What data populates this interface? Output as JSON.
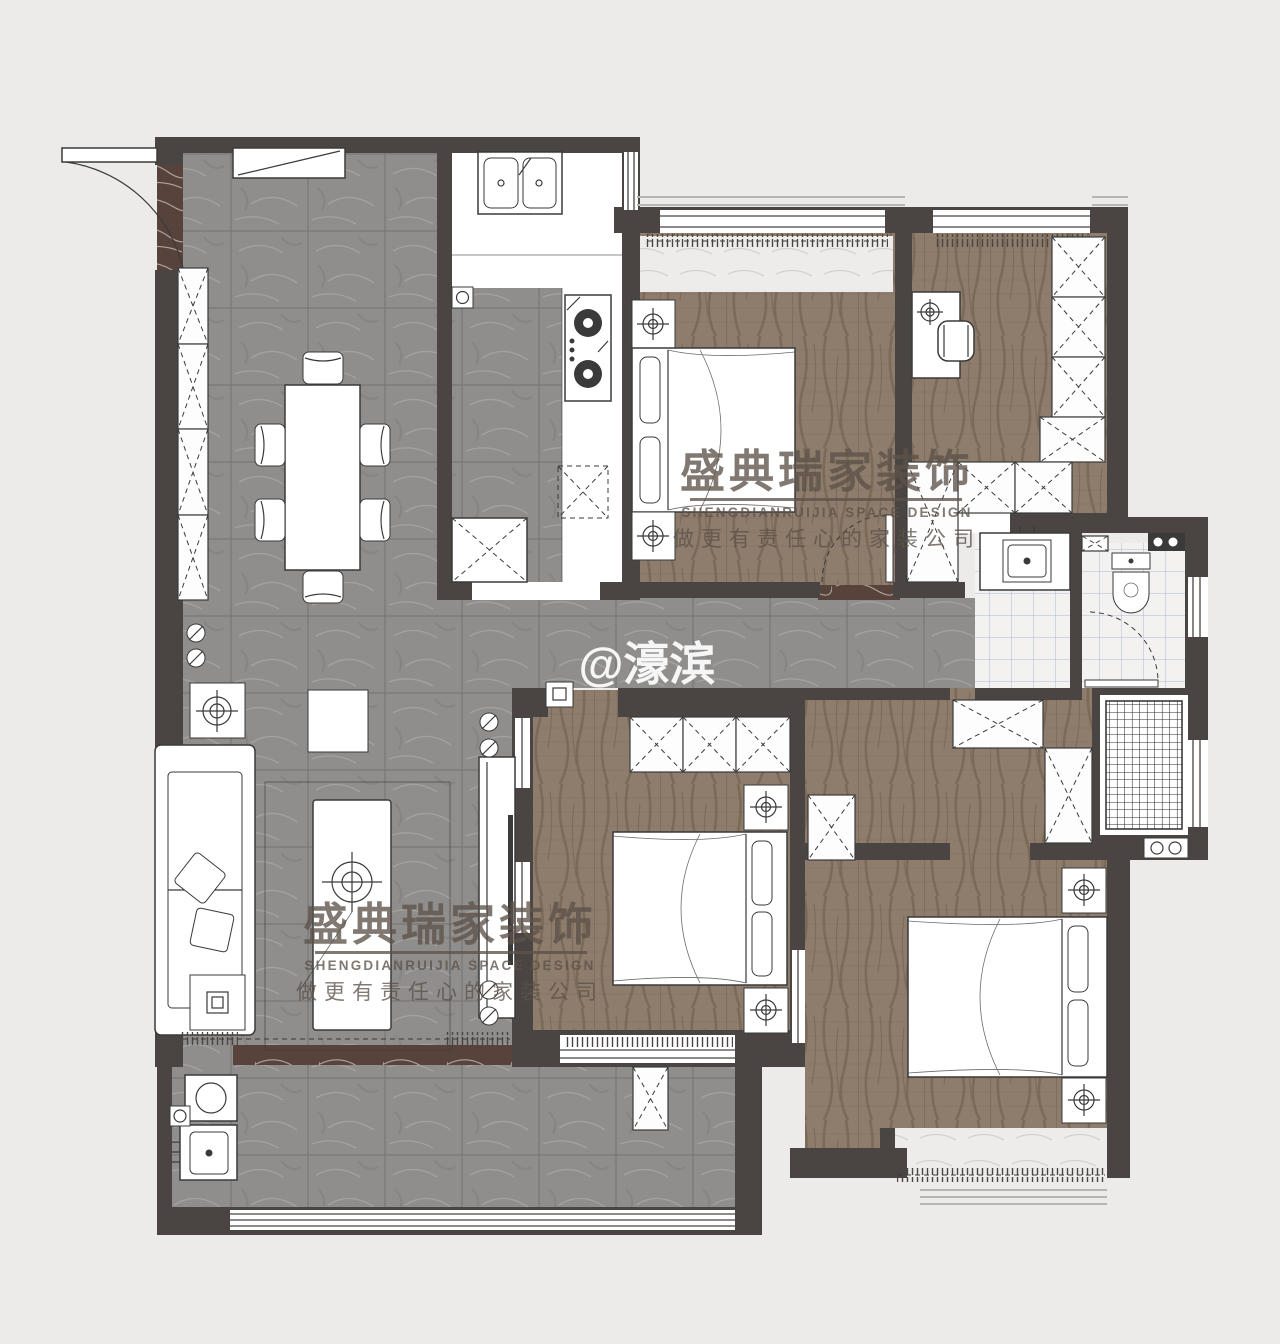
{
  "watermark": {
    "brand": "盛典瑞家装饰",
    "brand_en": "SHENGDIANRUIJIA SPACE DESIGN",
    "slogan": "做更有责任心的家装公司",
    "handle": "@濠滨"
  },
  "colors": {
    "bg": "#ecebe9",
    "wall": "#4a4543",
    "stroke": "#3a3a3a",
    "tile_base": "#908e8c",
    "tile_line": "#6e6c6a",
    "tile_vein": "#b2b0ae",
    "wood_base": "#8e7c6c",
    "wood_grain": "#6d5a49",
    "brown_marble": "#57433c",
    "brown_vein": "#d8cdc4",
    "bath_tile": "#f3f2f0",
    "bath_grid": "#a8aed2",
    "sill": "#edecea",
    "wm_dark": "rgba(92,82,73,0.78)",
    "wm_white": "rgba(255,255,255,0.92)"
  }
}
